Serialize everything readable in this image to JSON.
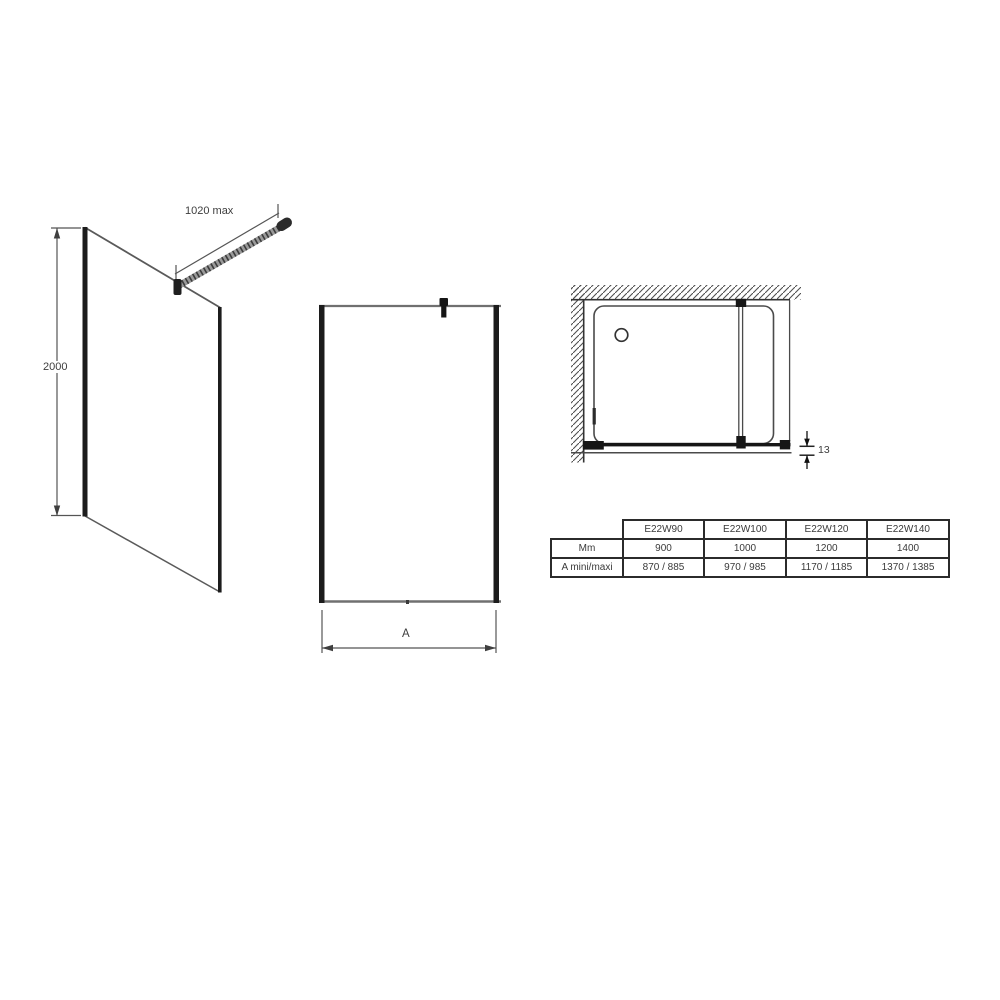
{
  "views": {
    "perspective": {
      "name": "walk-in shower panel perspective view",
      "bar_dimension": "1020 max",
      "height_dimension": "2000"
    },
    "front": {
      "name": "panel front elevation view",
      "width_dimension": "A"
    },
    "plan": {
      "name": "shower enclosure plan view",
      "glass_offset_dimension": "13"
    }
  },
  "spec_table": {
    "col_headers": [
      "E22W90",
      "E22W100",
      "E22W120",
      "E22W140"
    ],
    "rows": [
      {
        "label": "Mm",
        "values": [
          "900",
          "1000",
          "1200",
          "1400"
        ]
      },
      {
        "label": "A mini/maxi",
        "values": [
          "870 / 885",
          "970 / 985",
          "1170 / 1185",
          "1370 / 1385"
        ]
      }
    ]
  },
  "colors": {
    "line": "#4a4a4a",
    "thick_line": "#1c1c1c",
    "background": "#ffffff",
    "text": "#3d3d3d"
  }
}
